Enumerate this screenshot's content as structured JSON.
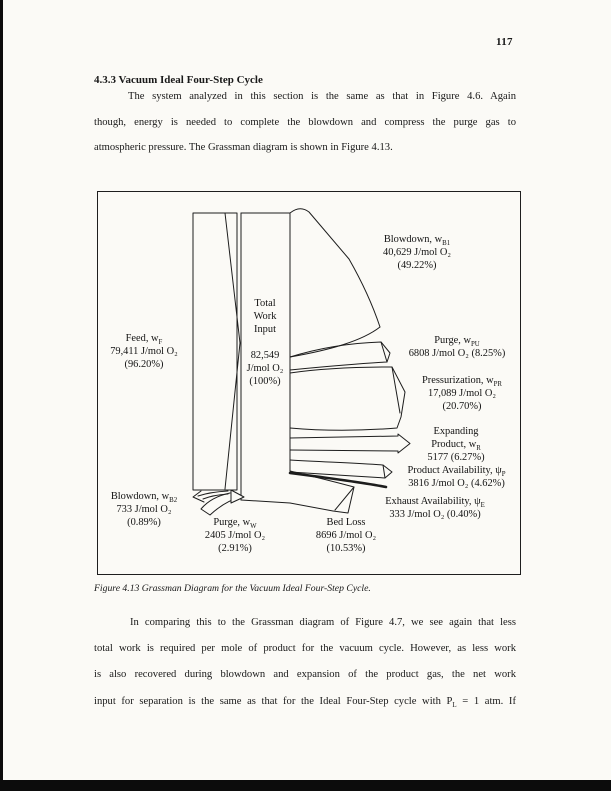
{
  "page": {
    "number": "117",
    "heading": "4.3.3  Vacuum Ideal Four-Step Cycle",
    "para1": {
      "line1": "The system analyzed in this section is the same as that in Figure 4.6.  Again",
      "line2": "though, energy is needed to complete the blowdown and compress the purge gas to",
      "line3": "atmospheric pressure.  The Grassman diagram is shown in Figure 4.13."
    },
    "caption": "Figure 4.13  Grassman Diagram for the Vacuum Ideal Four-Step Cycle.",
    "para2": {
      "line1": "In comparing this to the Grassman diagram of Figure 4.7, we see again that less",
      "line2": "total work is required per mole of product for the vacuum cycle.  However, as less work",
      "line3": "is also recovered during blowdown and expansion of the product gas, the net work",
      "line4": [
        {
          "t": "input for separation is the same as that for the Ideal Four-Step cycle with P"
        },
        {
          "s": "L"
        },
        {
          "t": " = 1 atm.  If"
        }
      ]
    }
  },
  "figure": {
    "labels": {
      "feed": {
        "lines": [
          [
            {
              "t": "Feed, w"
            },
            {
              "s": "F"
            }
          ],
          [
            {
              "t": "79,411 J/mol O₂"
            }
          ],
          [
            {
              "t": "(96.20%)"
            }
          ]
        ]
      },
      "total_title": {
        "lines": [
          [
            {
              "t": "Total"
            }
          ],
          [
            {
              "t": "Work"
            }
          ],
          [
            {
              "t": "Input"
            }
          ]
        ]
      },
      "total_value": {
        "lines": [
          [
            {
              "t": "82,549"
            }
          ],
          [
            {
              "t": "J/mol O₂"
            }
          ],
          [
            {
              "t": "(100%)"
            }
          ]
        ]
      },
      "blowdown_b1": {
        "lines": [
          [
            {
              "t": "Blowdown, w"
            },
            {
              "s": "B1"
            }
          ],
          [
            {
              "t": "40,629 J/mol O₂"
            }
          ],
          [
            {
              "t": "(49.22%)"
            }
          ]
        ]
      },
      "purge_pu": {
        "lines": [
          [
            {
              "t": "Purge, w"
            },
            {
              "s": "PU"
            }
          ],
          [
            {
              "t": "6808 J/mol O₂ (8.25%)"
            }
          ]
        ]
      },
      "pressurization": {
        "lines": [
          [
            {
              "t": "Pressurization, w"
            },
            {
              "s": "PR"
            }
          ],
          [
            {
              "t": "17,089 J/mol O₂"
            }
          ],
          [
            {
              "t": "(20.70%)"
            }
          ]
        ]
      },
      "expanding_product": {
        "lines": [
          [
            {
              "t": "Expanding"
            }
          ],
          [
            {
              "t": "Product, w"
            },
            {
              "s": "R"
            }
          ],
          [
            {
              "t": "5177 (6.27%)"
            }
          ]
        ]
      },
      "product_availability": {
        "lines": [
          [
            {
              "t": "Product Availability, ψ"
            },
            {
              "s": "P"
            }
          ],
          [
            {
              "t": "3816 J/mol O₂ (4.62%)"
            }
          ]
        ]
      },
      "exhaust_availability": {
        "lines": [
          [
            {
              "t": "Exhaust Availability, ψ"
            },
            {
              "s": "E"
            }
          ],
          [
            {
              "t": "333 J/mol O₂ (0.40%)"
            }
          ]
        ]
      },
      "bed_loss": {
        "lines": [
          [
            {
              "t": "Bed Loss"
            }
          ],
          [
            {
              "t": "8696 J/mol O₂"
            }
          ],
          [
            {
              "t": "(10.53%)"
            }
          ]
        ]
      },
      "purge_w": {
        "lines": [
          [
            {
              "t": "Purge, w"
            },
            {
              "s": "W"
            }
          ],
          [
            {
              "t": "2405 J/mol O₂"
            }
          ],
          [
            {
              "t": "(2.91%)"
            }
          ]
        ]
      },
      "blowdown_b2": {
        "lines": [
          [
            {
              "t": "Blowdown, w"
            },
            {
              "s": "B2"
            }
          ],
          [
            {
              "t": "733 J/mol O₂"
            }
          ],
          [
            {
              "t": "(0.89%)"
            }
          ]
        ]
      }
    }
  },
  "chart_data": {
    "type": "table",
    "title": "Grassman Diagram for the Vacuum Ideal Four-Step Cycle",
    "columns": [
      "Stream",
      "Value (J/mol O₂)",
      "Percent"
    ],
    "rows": [
      [
        "Feed, wF",
        "79,411",
        "96.20%"
      ],
      [
        "Total Work Input",
        "82,549",
        "100%"
      ],
      [
        "Blowdown, wB1",
        "40,629",
        "49.22%"
      ],
      [
        "Purge, wPU",
        "6808",
        "8.25%"
      ],
      [
        "Pressurization, wPR",
        "17,089",
        "20.70%"
      ],
      [
        "Expanding Product, wR",
        "5177",
        "6.27%"
      ],
      [
        "Product Availability, ψP",
        "3816",
        "4.62%"
      ],
      [
        "Exhaust Availability, ψE",
        "333",
        "0.40%"
      ],
      [
        "Bed Loss",
        "8696",
        "10.53%"
      ],
      [
        "Purge, wW",
        "2405",
        "2.91%"
      ],
      [
        "Blowdown, wB2",
        "733",
        "0.89%"
      ]
    ]
  }
}
